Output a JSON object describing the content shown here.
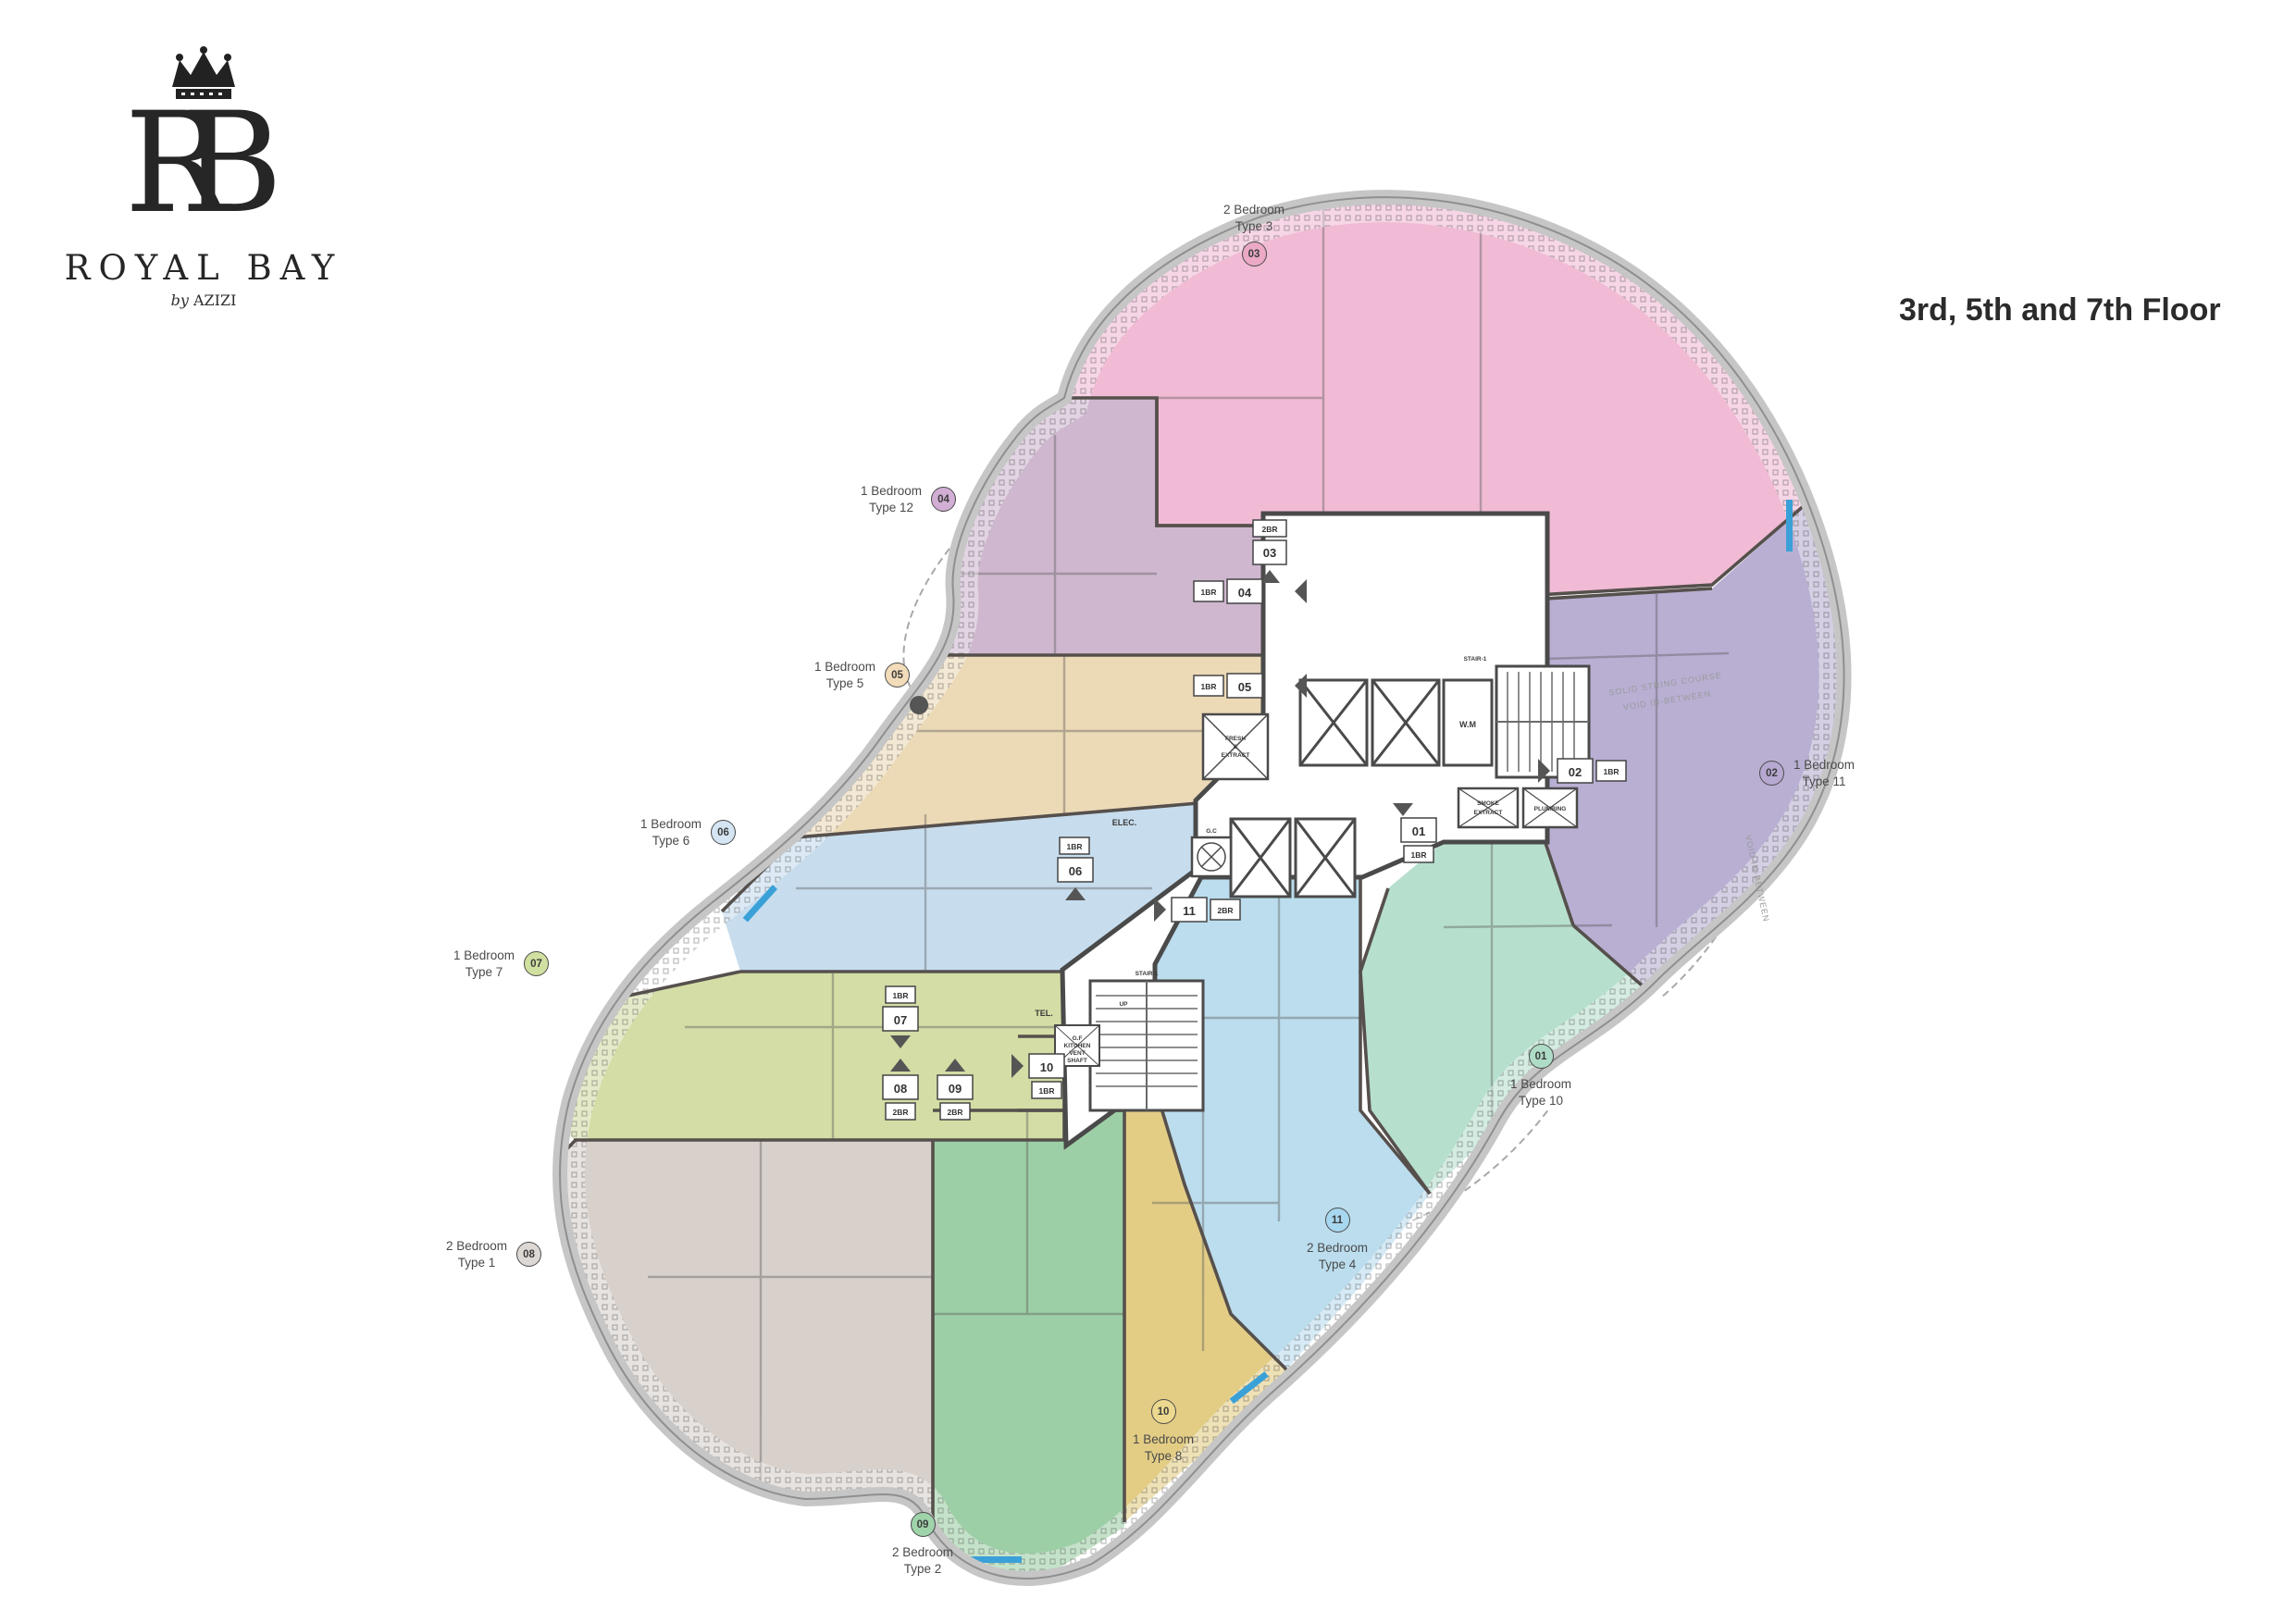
{
  "brand": {
    "monogram_r": "R",
    "monogram_b": "B",
    "name": "ROYAL BAY",
    "byline_by": "by",
    "byline_name": "AZIZI"
  },
  "page_title": "3rd, 5th and 7th Floor",
  "units": [
    {
      "no": "01",
      "line1": "1 Bedroom",
      "line2": "Type 10",
      "br": "1BR",
      "badge_color": "#aedcc6",
      "area_color": "#b7dfcd"
    },
    {
      "no": "02",
      "line1": "1 Bedroom",
      "line2": "Type 11",
      "br": "1BR",
      "badge_color": "#b7a8d2",
      "area_color": "#b9afd3"
    },
    {
      "no": "03",
      "line1": "2 Bedroom",
      "line2": "Type 3",
      "br": "2BR",
      "badge_color": "#eba9c6",
      "area_color": "#f1bbd5"
    },
    {
      "no": "04",
      "line1": "1 Bedroom",
      "line2": "Type 12",
      "br": "1BR",
      "badge_color": "#d2aed4",
      "area_color": "#cfb7cf"
    },
    {
      "no": "05",
      "line1": "1 Bedroom",
      "line2": "Type 5",
      "br": "1BR",
      "badge_color": "#f3dcba",
      "area_color": "#ecd9b6"
    },
    {
      "no": "06",
      "line1": "1 Bedroom",
      "line2": "Type 6",
      "br": "1BR",
      "badge_color": "#d5e5f3",
      "area_color": "#c7ddee"
    },
    {
      "no": "07",
      "line1": "1 Bedroom",
      "line2": "Type 7",
      "br": "1BR",
      "badge_color": "#d0e0a0",
      "area_color": "#d3dda5"
    },
    {
      "no": "08",
      "line1": "2 Bedroom",
      "line2": "Type 1",
      "br": "2BR",
      "badge_color": "#ded8d5",
      "area_color": "#d8d0cb"
    },
    {
      "no": "09",
      "line1": "2 Bedroom",
      "line2": "Type 2",
      "br": "2BR",
      "badge_color": "#9fd3aa",
      "area_color": "#9dcfa6"
    },
    {
      "no": "10",
      "line1": "1 Bedroom",
      "line2": "Type 8",
      "br": "1BR",
      "badge_color": "#ecd98f",
      "area_color": "#e3cd85"
    },
    {
      "no": "11",
      "line1": "2 Bedroom",
      "line2": "Type 4",
      "br": "2BR",
      "badge_color": "#a8d8f0",
      "area_color": "#bbddee"
    }
  ],
  "plan_labels": {
    "elec": "ELEC.",
    "tel": "TEL.",
    "wm": "W.M",
    "gc": "G.C",
    "stair_upper": "STAIR-1",
    "stair_lower": "STAIR-1",
    "up": "UP",
    "fresh_extract": "FRESH & EXTRACT",
    "smoke_extract": "SMOKE EXTRACT",
    "plumbing": "PLUMBING",
    "kitchen_vent": "G.F KITCHEN VENT SHAFT",
    "void_note": "VOID IN-BETWEEN",
    "solid_note": "SOLID STRING COURSE"
  }
}
